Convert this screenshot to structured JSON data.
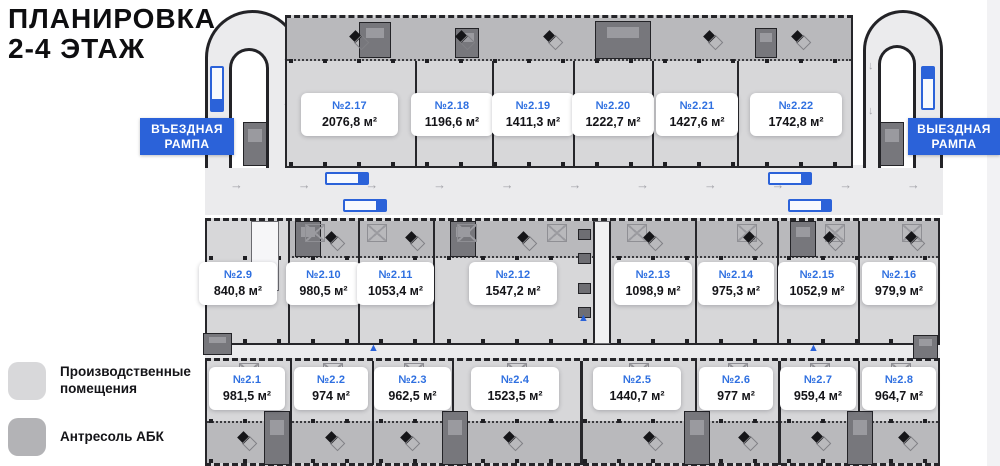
{
  "title": {
    "line1": "ПЛАНИРОВКА",
    "line2": "2-4 ЭТАЖ"
  },
  "ramps": {
    "entry": "ВЪЕЗДНАЯ РАМПА",
    "exit": "ВЫЕЗДНАЯ РАМПА"
  },
  "legend": {
    "items": [
      {
        "label": "Производственные помещения",
        "color": "#d7d7d9"
      },
      {
        "label": "Антресоль АБК",
        "color": "#b3b3b6"
      }
    ]
  },
  "units": {
    "top": [
      {
        "no": "№2.17",
        "area": "2076,8 м²"
      },
      {
        "no": "№2.18",
        "area": "1196,6 м²"
      },
      {
        "no": "№2.19",
        "area": "1411,3 м²"
      },
      {
        "no": "№2.20",
        "area": "1222,7 м²"
      },
      {
        "no": "№2.21",
        "area": "1427,6 м²"
      },
      {
        "no": "№2.22",
        "area": "1742,8 м²"
      }
    ],
    "middle": [
      {
        "no": "№2.9",
        "area": "840,8 м²"
      },
      {
        "no": "№2.10",
        "area": "980,5 м²"
      },
      {
        "no": "№2.11",
        "area": "1053,4 м²"
      },
      {
        "no": "№2.12",
        "area": "1547,2 м²"
      },
      {
        "no": "№2.13",
        "area": "1098,9 м²"
      },
      {
        "no": "№2.14",
        "area": "975,3 м²"
      },
      {
        "no": "№2.15",
        "area": "1052,9 м²"
      },
      {
        "no": "№2.16",
        "area": "979,9 м²"
      }
    ],
    "bottom": [
      {
        "no": "№2.1",
        "area": "981,5 м²"
      },
      {
        "no": "№2.2",
        "area": "974 м²"
      },
      {
        "no": "№2.3",
        "area": "962,5 м²"
      },
      {
        "no": "№2.4",
        "area": "1523,5 м²"
      },
      {
        "no": "№2.5",
        "area": "1440,7 м²"
      },
      {
        "no": "№2.6",
        "area": "977 м²"
      },
      {
        "no": "№2.7",
        "area": "959,4 м²"
      },
      {
        "no": "№2.8",
        "area": "964,7 м²"
      }
    ]
  },
  "icons": {
    "arrow_right": "→",
    "arrow_up": "↑",
    "arrow_down": "↓",
    "stairs": "▲"
  },
  "colors": {
    "accent_blue": "#2b62d9",
    "unit_number_blue": "#2e6fe0",
    "unit_fill": "#d7d7d9",
    "mezzanine_fill": "#b9b9bc",
    "road_fill": "#ebebed",
    "wall": "#26262a"
  }
}
